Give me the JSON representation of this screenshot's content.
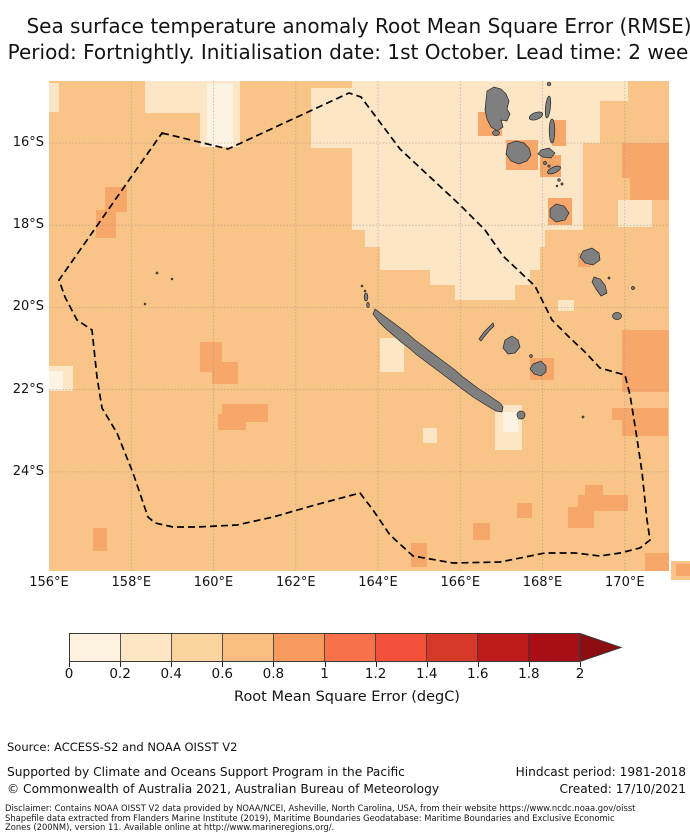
{
  "title": {
    "line1": "Sea surface temperature anomaly Root Mean Square Error (RMSE)",
    "line2": "Period: Fortnightly. Initialisation date: 1st October. Lead time: 2 weeks"
  },
  "map": {
    "x_tick_labels": [
      "156°E",
      "158°E",
      "160°E",
      "162°E",
      "164°E",
      "166°E",
      "168°E",
      "170°E"
    ],
    "y_tick_labels": [
      "16°S",
      "18°S",
      "20°S",
      "22°S",
      "24°S"
    ],
    "palette": {
      "base": "#f9c488",
      "pale": "#fce6c5",
      "lightest": "#fdf3e2",
      "dark": "#f8a76b",
      "land": "#7f7f7f"
    },
    "overlay_names": [
      "eez-boundary-dashed",
      "land-islands"
    ]
  },
  "colorbar": {
    "tick_labels": [
      "0",
      "0.2",
      "0.4",
      "0.6",
      "0.8",
      "1",
      "1.2",
      "1.4",
      "1.6",
      "1.8",
      "2"
    ],
    "label": "Root Mean Square Error (degC)",
    "colors": [
      "#fdf2e0",
      "#fce6c4",
      "#fbd49e",
      "#f9bd81",
      "#f89a5e",
      "#f7714b",
      "#f25038",
      "#d63928",
      "#bd1a1c",
      "#a90e15"
    ],
    "arrow_color": "#8b0d12"
  },
  "footer": {
    "source": "Source: ACCESS-S2 and NOAA OISST V2",
    "supported": "Supported by Climate and Oceans Support Program in the Pacific",
    "copyright": "© Commonwealth of Australia 2021, Australian Bureau of Meteorology",
    "hindcast": "Hindcast period: 1981-2018",
    "created": "Created: 17/10/2021",
    "disclaimer_line1": "Disclaimer: Contains NOAA OISST V2 data provided by NOAA/NCEI, Asheville, North Carolina, USA, from their website https://www.ncdc.noaa.gov/oisst",
    "disclaimer_line2": "Shapefile data extracted from Flanders Marine Institute (2019), Maritime Boundaries Geodatabase: Maritime Boundaries and Exclusive Economic",
    "disclaimer_line3": "Zones (200NM), version 11. Available online at http://www.marineregions.org/."
  },
  "chart_data": {
    "type": "heatmap",
    "title": "Sea surface temperature anomaly Root Mean Square Error (RMSE)",
    "subtitle": "Period: Fortnightly. Initialisation date: 1st October. Lead time: 2 weeks",
    "value_label": "Root Mean Square Error (degC)",
    "colorbar_bins": [
      0,
      0.2,
      0.4,
      0.6,
      0.8,
      1,
      1.2,
      1.4,
      1.6,
      1.8,
      2
    ],
    "colorbar_extend": "max",
    "lon_ticks": [
      156,
      158,
      160,
      162,
      164,
      166,
      168,
      170
    ],
    "lat_ticks": [
      -16,
      -18,
      -20,
      -22,
      -24
    ],
    "lon_range": [
      156,
      171.1
    ],
    "lat_range": [
      -26.4,
      -14.5
    ],
    "grid": true,
    "regions": [
      {
        "area": "majority of domain (Coral Sea around New Caledonia)",
        "rmse_degc": [
          0.4,
          0.6
        ]
      },
      {
        "area": "north-eastern sector around Vanuatu",
        "rmse_degc": [
          0.2,
          0.4
        ]
      },
      {
        "area": "scattered cells near islands, along eastern edge and in the south-east",
        "rmse_degc": [
          0.6,
          0.8
        ]
      },
      {
        "area": "isolated cells (west edge near 22S, south of Grande Terre, top centre)",
        "rmse_degc": [
          0.0,
          0.2
        ]
      }
    ],
    "overlays": [
      "New Caledonia EEZ boundary (black dashed polygon)",
      "land mask: New Caledonia and Vanuatu islands (grey)"
    ]
  }
}
